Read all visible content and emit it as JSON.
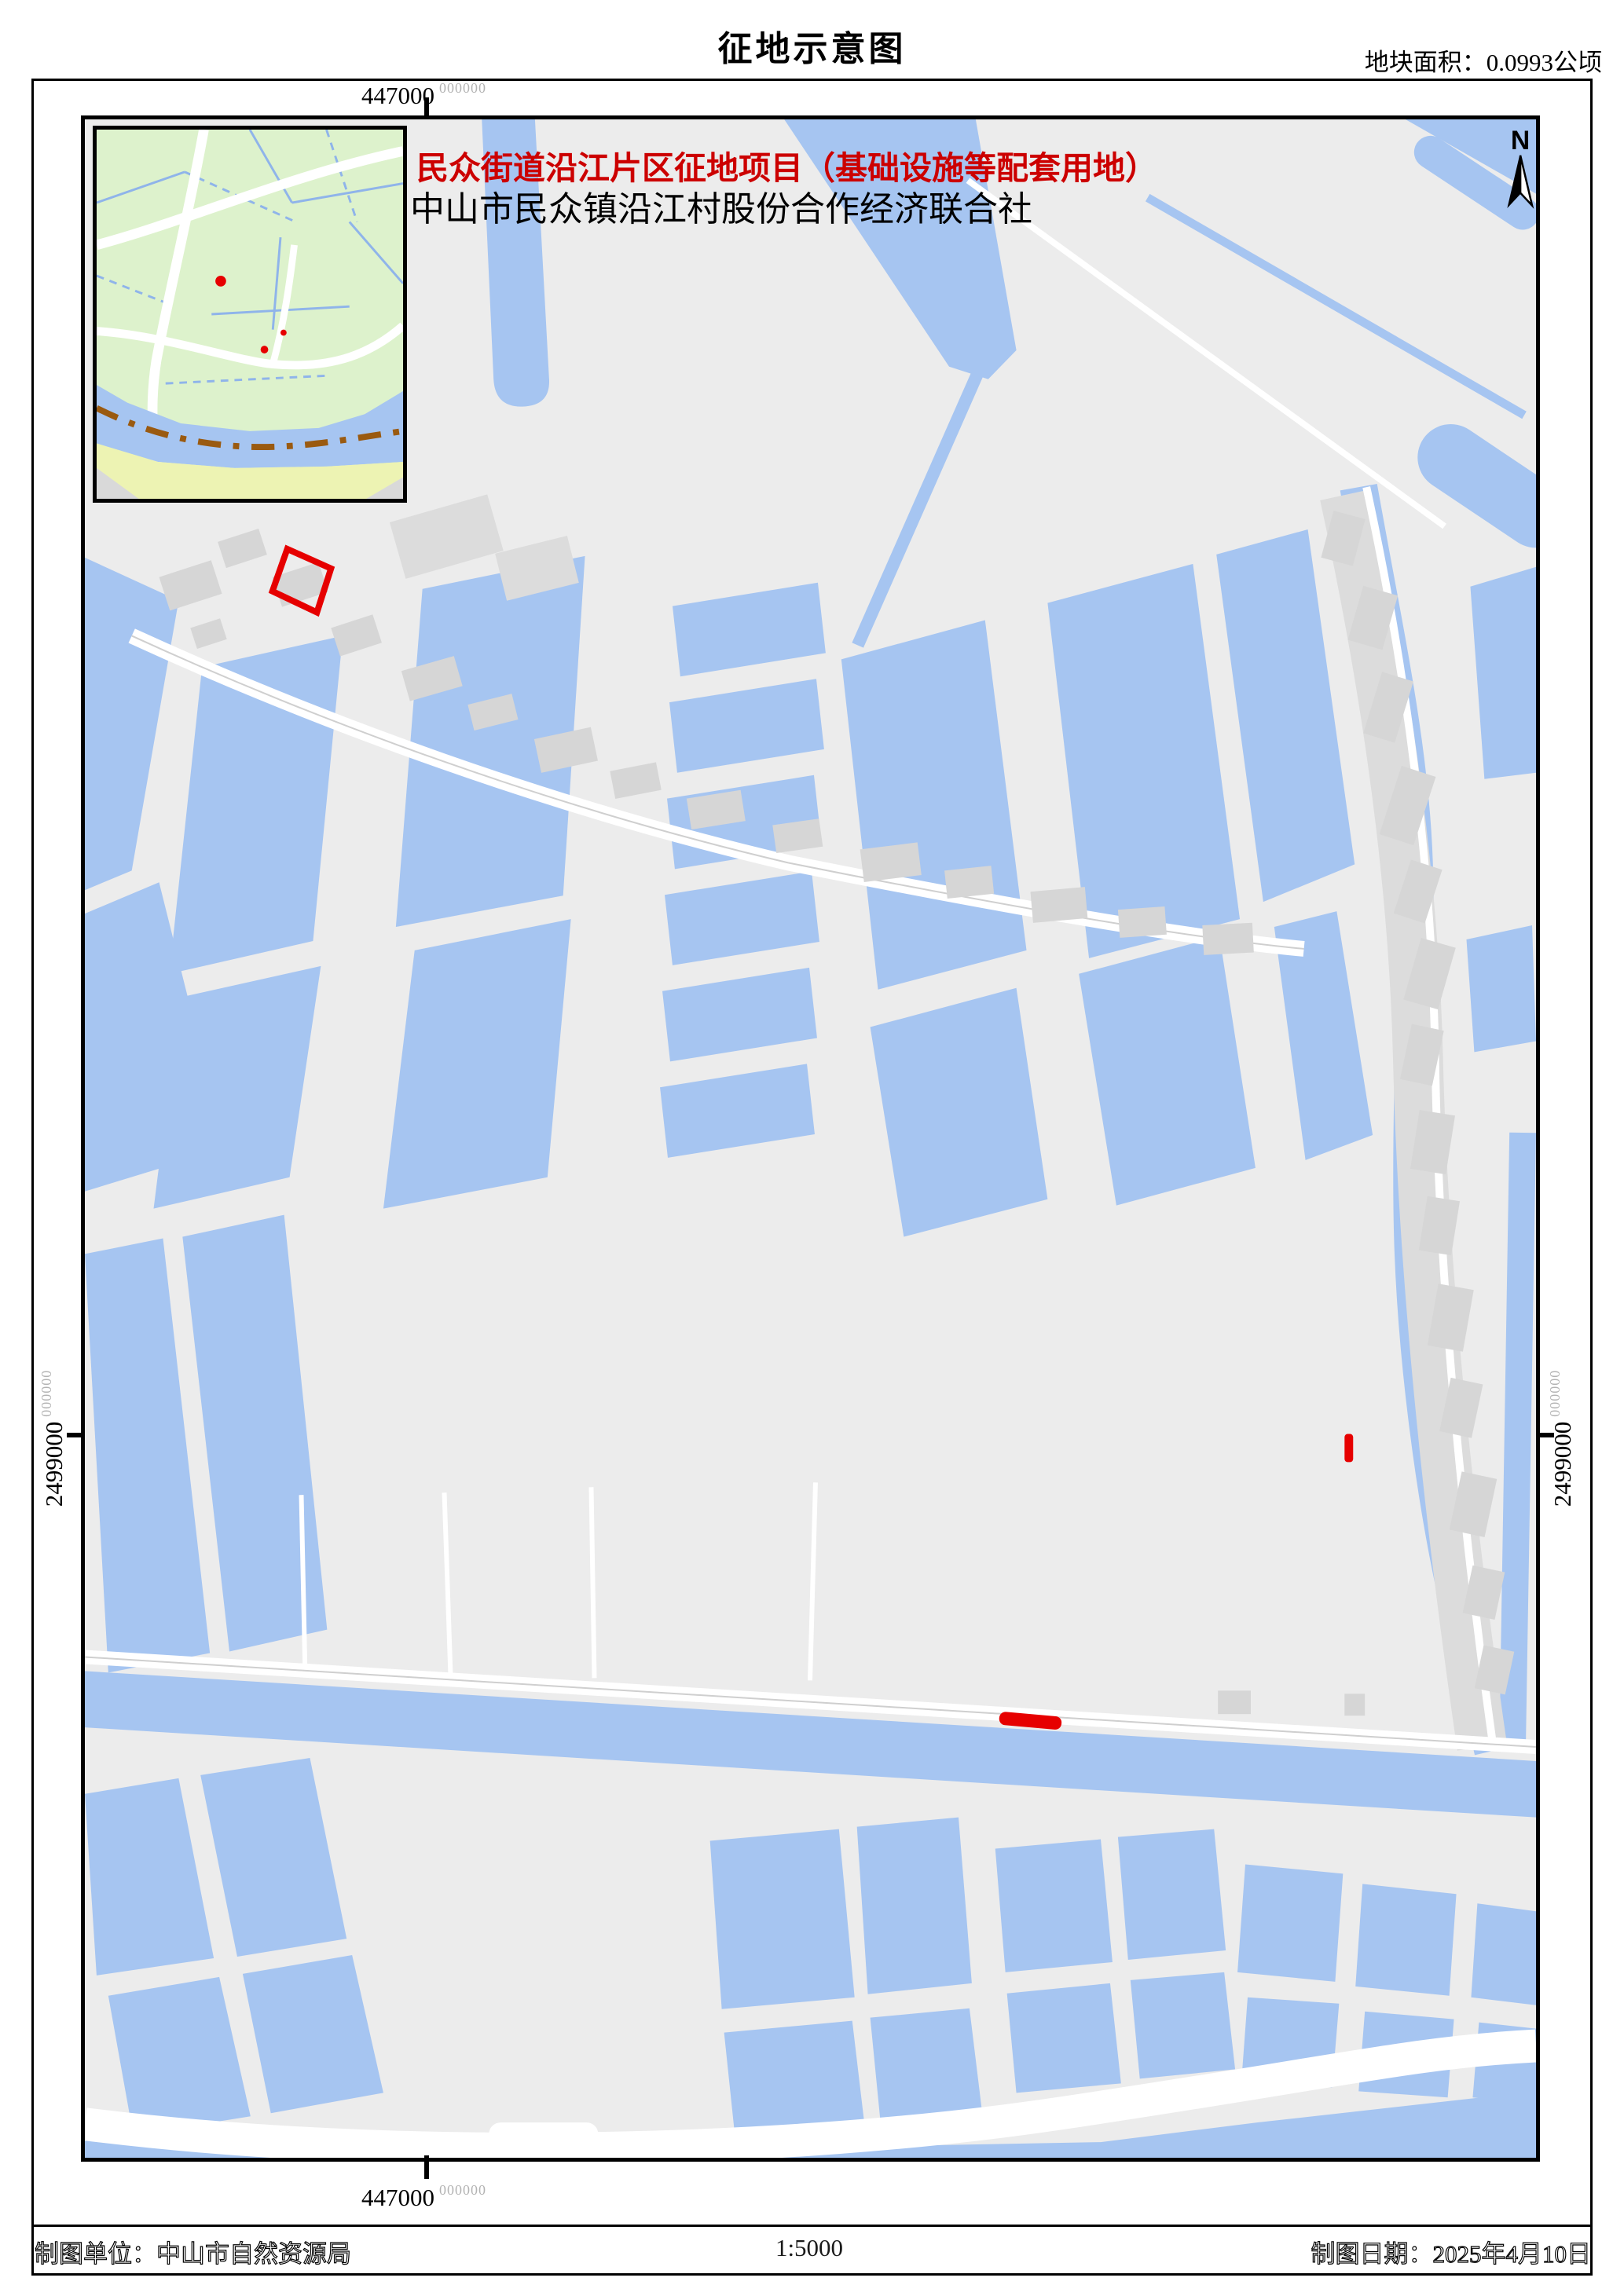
{
  "doc": {
    "title": "征地示意图",
    "area_note": "地块面积：0.0993公顷"
  },
  "mapc": {
    "project_title": "民众街道沿江片区征地项目（基础设施等配套用地）",
    "organization": "中山市民众镇沿江村股份合作经济联合社",
    "north_label": "N",
    "coordinates": {
      "top": {
        "value": "447000",
        "decimals": "000000"
      },
      "bottom": {
        "value": "447000",
        "decimals": "000000"
      },
      "left": {
        "value": "2499000",
        "decimals": "000000"
      },
      "right": {
        "value": "2499000",
        "decimals": "000000"
      }
    },
    "plots": {
      "outline_parcel": "red quadrilateral outline near northwest village",
      "field_marker": "small red bar in central field",
      "riverbank_marker": "red strip on north bank of river"
    }
  },
  "footer": {
    "agency": "制图单位：中山市自然资源局",
    "scale": "1:5000",
    "date": "制图日期：2025年4月10日"
  },
  "colors": {
    "water": "#a6c5f1",
    "land": "#ececec",
    "building": "#d6d6d6",
    "road": "#ffffff",
    "inset_green": "#ddf2cc",
    "inset_yellow": "#edf3b3",
    "boundary_brown": "#9a5a10",
    "highlight_red": "#e60000",
    "heading_red": "#cc0000",
    "coord_superscript_gray": "#b3b3b3"
  }
}
